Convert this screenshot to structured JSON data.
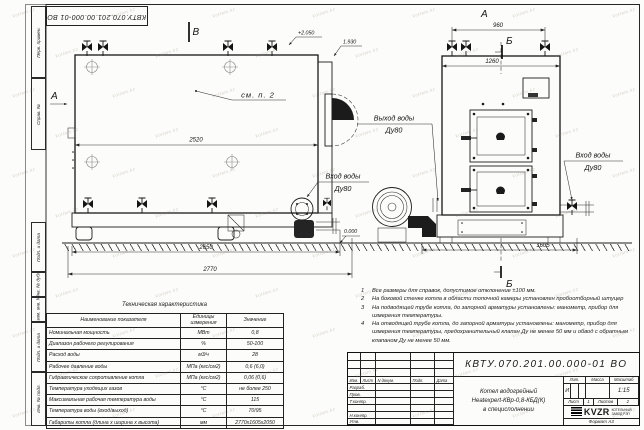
{
  "doc": {
    "number": "КВТУ.070.201.00.000-01 ВО"
  },
  "frame": {
    "margin_top_1": "Перв. примен.",
    "margin_top_2": "Справ. №",
    "margin_bot_1": "Подп. и дата",
    "margin_bot_2": "Инв. № дубл.",
    "margin_bot_3": "Взам. инв. №",
    "margin_bot_4": "Подп. и дата",
    "margin_bot_5": "Инв. № подл."
  },
  "drawing": {
    "views": {
      "front": "А",
      "section": "Б",
      "top": "В",
      "side": "А",
      "section_bottom": "Б"
    },
    "dims": {
      "side_top": "2520",
      "side_mid": "2650",
      "side_total": "2770",
      "front_top": "960",
      "front_width": "1260",
      "front_base": "1605"
    },
    "elevations": {
      "top": "+2.050",
      "chimney": "1.930",
      "ground": "0.000"
    },
    "labels": {
      "outlet": "Выход воды",
      "outlet_dn": "Ду80",
      "inlet_left": "Вход воды",
      "inlet_left_dn": "Ду80",
      "inlet_right": "Вход воды",
      "inlet_right_dn": "Ду80",
      "see_note": "см. п. 2"
    }
  },
  "notes": [
    {
      "num": "1",
      "text": "Все размеры для справок, допустимое отклонение ±100 мм."
    },
    {
      "num": "2",
      "text": "На боковой стенке котла в области топочной камеры установлен пробоотборный штуцер"
    },
    {
      "num": "3",
      "text": "На подводящей трубе котла, до запорной арматуры установлены: манометр, прибор для измерения температуры."
    },
    {
      "num": "4",
      "text": "На отводящей трубе котла, до запорной арматуры установлены: манометр, прибор для измерения температуры, предохранительный клапан Ду не менее 50 мм и обвод с обратным клапаном Ду не менее 50 мм."
    }
  ],
  "spec_table": {
    "title": "Техническая характеристика",
    "headers": [
      "Наименование показателя",
      "Единицы измерения",
      "Значение"
    ],
    "rows": [
      [
        "Номинальная мощность",
        "МВт",
        "0,8"
      ],
      [
        "Диапазон рабочего регулирования",
        "%",
        "50-100"
      ],
      [
        "Расход воды",
        "м3/ч",
        "28"
      ],
      [
        "Рабочее давление воды",
        "МПа (кгс/см2)",
        "0,6 (6,0)"
      ],
      [
        "Гидравлическое сопротивление котла",
        "МПа (кгс/см2)",
        "0,06 (0,6)"
      ],
      [
        "Температура уходящих газов",
        "°С",
        "не более 250"
      ],
      [
        "Максимальная рабочая температура воды",
        "°С",
        "115"
      ],
      [
        "Температура воды (вход/выход)",
        "°С",
        "70/95"
      ],
      [
        "Габариты котла (длина х ширина х высота)",
        "мм",
        "2770х1605х2050"
      ]
    ]
  },
  "title_block": {
    "doc_number": "КВТУ.070.201.00.000-01 ВО",
    "change_header": [
      "Изм.",
      "Лист",
      "N докум.",
      "Подп.",
      "Дата"
    ],
    "sign_rows": [
      "Разраб.",
      "Пров.",
      "Т.контр.",
      "",
      "Н.контр.",
      "Утв."
    ],
    "product_line1": "Котел водогрейный",
    "product_line2": "Heatexpert-КВр-0,8-КБД(К)",
    "product_line3": "в специсполнении",
    "lit_label": "Лит.",
    "mass_label": "Масса",
    "scale_label": "Масштаб",
    "lit_value": "И",
    "scale_value": "1:15",
    "sheet_label": "Лист",
    "sheet_value": "1",
    "sheets_label": "Листов",
    "sheets_value": "2",
    "logo_text": "KVZR",
    "company_line1": "КОТЕЛЬНЫЙ",
    "company_line2": "ЗАВОД РЭП",
    "format_label": "Формат А3"
  },
  "watermark": {
    "text": "kotlam.kz"
  }
}
